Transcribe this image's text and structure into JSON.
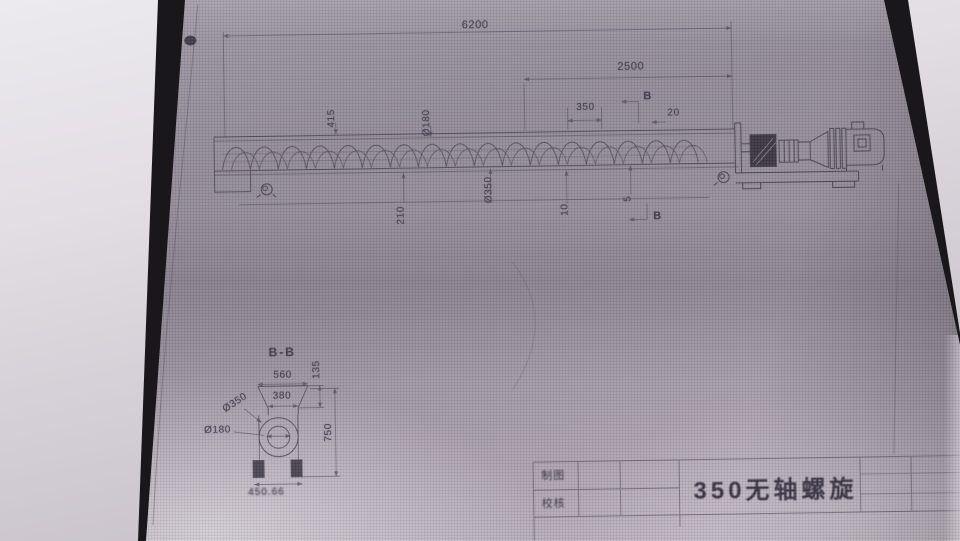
{
  "colors": {
    "paper": "#9a929f",
    "ink": "#4a4455",
    "backing": "#1a171c",
    "table_surface": "#d9d5da"
  },
  "drawing": {
    "main_view": {
      "dim_overall_length": "6200",
      "dim_drive_span": "2500",
      "dim_pitch": "350",
      "dim_20": "20",
      "dim_415": "415",
      "dim_dia180": "Ø180",
      "dim_210": "210",
      "dim_dia350": "Ø350",
      "dim_10": "10",
      "dim_5": "5",
      "section_letter_top": "B",
      "section_letter_bottom": "B"
    },
    "section_view": {
      "title": "B-B",
      "dim_top_width": "560",
      "dim_throat_width": "380",
      "dim_135": "135",
      "dim_height": "750",
      "dim_outer_dia": "Ø350",
      "dim_inner_dia": "Ø180",
      "dim_foot_span": "450.66"
    },
    "title_block": {
      "drawn_by_label": "制图",
      "checked_by_label": "校核",
      "drawing_title": "350无轴螺旋"
    }
  }
}
